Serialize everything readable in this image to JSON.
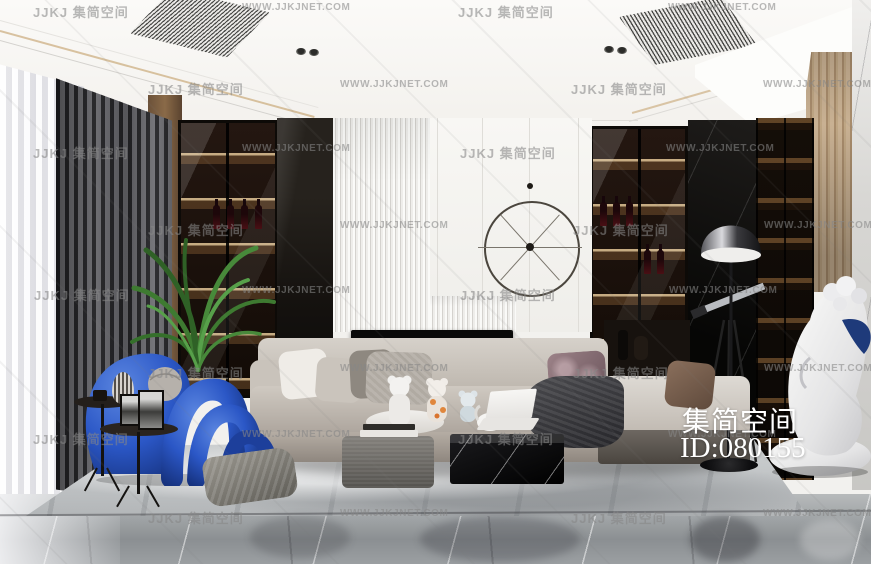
{
  "image": {
    "width": 871,
    "height": 564,
    "description": "Modern luxury living-room interior render with fireplace, wine cabinets, blue sculptural chair and cherub statue"
  },
  "branding": {
    "name_cn": "集简空间",
    "id": "ID:080155"
  },
  "watermark": {
    "logo_text": "JJKJ 集简空间",
    "url_text": "WWW.JJKJNET.COM",
    "rows": [
      {
        "y": 2,
        "items": [
          {
            "x": 33,
            "t": "logo"
          },
          {
            "x": 242,
            "t": "url"
          },
          {
            "x": 458,
            "t": "logo"
          },
          {
            "x": 668,
            "t": "url"
          }
        ]
      },
      {
        "y": 79,
        "items": [
          {
            "x": 148,
            "t": "logo"
          },
          {
            "x": 340,
            "t": "url"
          },
          {
            "x": 571,
            "t": "logo"
          },
          {
            "x": 763,
            "t": "url"
          }
        ]
      },
      {
        "y": 143,
        "items": [
          {
            "x": 33,
            "t": "logo"
          },
          {
            "x": 242,
            "t": "url"
          },
          {
            "x": 460,
            "t": "logo"
          },
          {
            "x": 666,
            "t": "url"
          }
        ]
      },
      {
        "y": 220,
        "items": [
          {
            "x": 148,
            "t": "logo"
          },
          {
            "x": 340,
            "t": "url"
          },
          {
            "x": 573,
            "t": "logo"
          },
          {
            "x": 764,
            "t": "url"
          }
        ]
      },
      {
        "y": 285,
        "items": [
          {
            "x": 34,
            "t": "logo"
          },
          {
            "x": 242,
            "t": "url"
          },
          {
            "x": 460,
            "t": "logo"
          },
          {
            "x": 669,
            "t": "url"
          }
        ]
      },
      {
        "y": 363,
        "items": [
          {
            "x": 148,
            "t": "logo"
          },
          {
            "x": 340,
            "t": "url"
          },
          {
            "x": 573,
            "t": "logo"
          },
          {
            "x": 764,
            "t": "url"
          }
        ]
      },
      {
        "y": 429,
        "items": [
          {
            "x": 33,
            "t": "logo"
          },
          {
            "x": 242,
            "t": "url"
          },
          {
            "x": 458,
            "t": "logo"
          },
          {
            "x": 668,
            "t": "url"
          }
        ]
      },
      {
        "y": 508,
        "items": [
          {
            "x": 148,
            "t": "logo"
          },
          {
            "x": 340,
            "t": "url"
          },
          {
            "x": 571,
            "t": "logo"
          },
          {
            "x": 763,
            "t": "url"
          }
        ]
      }
    ]
  },
  "palette": {
    "blue_chair": "#2b57c6",
    "fire_orange": "#ff9320",
    "cabinet_glow": "#e8cb96",
    "curtain_dark": "#3a3a3f",
    "sofa_gray": "#c9c2ba",
    "floor_gray": "#9aa0a2",
    "rug_gray": "#c6c9cb",
    "statue_white": "#f0f0ef",
    "wing_blue": "#1e3a7a",
    "brand_text": "#ffffff",
    "watermark_gray": "#868686"
  }
}
